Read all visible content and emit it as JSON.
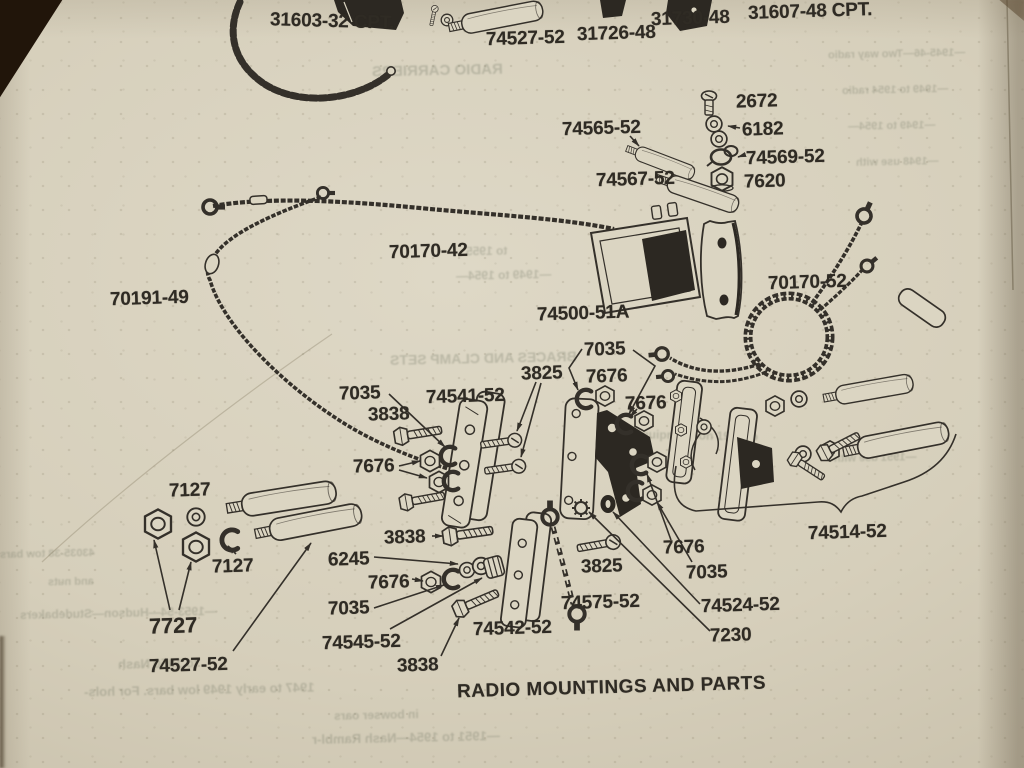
{
  "diagram": {
    "title": "RADIO MOUNTINGS AND PARTS",
    "colors": {
      "paper": "#d8d1bd",
      "ink": "#34302a",
      "dark_part": "#2c2822",
      "photo_corner": "#21150a"
    },
    "part_labels": [
      "31603-32 CPT.",
      "74527-52",
      "31726-48",
      "31730-48",
      "31607-48 CPT.",
      "2672",
      "74565-52",
      "6182",
      "74569-52",
      "74567-52",
      "7620",
      "70170-42",
      "70191-49",
      "74500-51A",
      "70170-52",
      "7035",
      "3825",
      "7676",
      "7035",
      "74541-52",
      "7676",
      "3838",
      "7676",
      "7127",
      "3838",
      "6245",
      "7127",
      "7676",
      "3825",
      "7676",
      "7035",
      "74514-52",
      "7035",
      "74575-52",
      "74524-52",
      "7727",
      "74545-52",
      "74542-52",
      "7230",
      "74527-52",
      "3838"
    ],
    "ghost_texts": [
      "RADIO CARRIERS",
      "—1945-46—Two way radio",
      "—1949 to 1954 radio",
      "—1949 to 1954—",
      "—1948 use with",
      "to 1955",
      "—1949 to 1954—",
      "BRACES AND CLAMP SETS",
      "Original equipment on 1947 to",
      "—1953-54—Hudson—Studebakers",
      "to 1950 Nash",
      "1947 to early 1949 low bars. For hols-",
      "in bowser oars",
      "—1951 to 1954—Nash Rambl-r",
      "43035-38 tow bars",
      "and nuts",
      "—1951 use with"
    ]
  }
}
